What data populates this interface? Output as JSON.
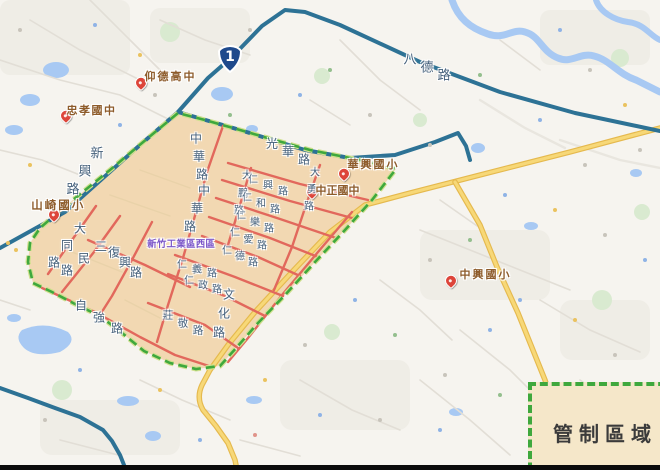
{
  "legend": {
    "label": "管制區域"
  },
  "shield": {
    "number": "1"
  },
  "colors": {
    "zone": "#f2d8b2",
    "border": "#3fa83d",
    "red": "#e2685c",
    "teal": "#2d7295",
    "yellow": "#f7d878",
    "water": "#a8c9f3",
    "label-road": "#46617c",
    "label-school": "#8d5b2a",
    "label-area": "#7a55c8",
    "marker": "#dd453a",
    "legend-bg": "#f5e7c9",
    "legend-text": "#3b3b3b"
  },
  "map": {
    "labels": [
      {
        "text": "八德路",
        "x": 410,
        "y": 58,
        "dx": 17,
        "dy": 8,
        "size": 13,
        "cls": "road"
      },
      {
        "text": "新興路",
        "x": 97,
        "y": 152,
        "dx": -12,
        "dy": 18,
        "size": 13,
        "cls": "road"
      },
      {
        "text": "光華路",
        "x": 272,
        "y": 143,
        "dx": 16,
        "dy": 8,
        "size": 12,
        "cls": "road"
      },
      {
        "text": "中華路",
        "x": 196,
        "y": 138,
        "dx": 3,
        "dy": 18,
        "size": 12,
        "cls": "road"
      },
      {
        "text": "中華路",
        "x": 204,
        "y": 190,
        "dx": -7,
        "dy": 18,
        "size": 12,
        "cls": "road"
      },
      {
        "text": "大勇路",
        "x": 315,
        "y": 171,
        "dx": -3,
        "dy": 17,
        "size": 10,
        "cls": "road"
      },
      {
        "text": "大鵬路",
        "x": 247,
        "y": 174,
        "dx": -4,
        "dy": 17.5,
        "size": 10,
        "cls": "road"
      },
      {
        "text": "文化路",
        "x": 229,
        "y": 294,
        "dx": -5,
        "dy": 19,
        "size": 12,
        "cls": "road"
      },
      {
        "text": "大同路",
        "x": 80,
        "y": 228,
        "dx": -13,
        "dy": 17,
        "size": 12,
        "cls": "road"
      },
      {
        "text": "三民路",
        "x": 101,
        "y": 246,
        "dx": -17,
        "dy": 12,
        "size": 12,
        "cls": "road"
      },
      {
        "text": "復興路",
        "x": 114,
        "y": 252,
        "dx": 11,
        "dy": 10,
        "size": 12,
        "cls": "road"
      },
      {
        "text": "自強路",
        "x": 81,
        "y": 305,
        "dx": 18,
        "dy": 11.5,
        "size": 12,
        "cls": "road"
      },
      {
        "text": "莊敬路",
        "x": 168,
        "y": 315,
        "dx": 15,
        "dy": 7.5,
        "size": 10.5,
        "cls": "road"
      },
      {
        "text": "仁興路",
        "x": 253,
        "y": 178,
        "dx": 15,
        "dy": 6,
        "size": 10,
        "cls": "road"
      },
      {
        "text": "仁和路",
        "x": 247,
        "y": 196,
        "dx": 14,
        "dy": 6,
        "size": 10,
        "cls": "road"
      },
      {
        "text": "仁樂路",
        "x": 241,
        "y": 214,
        "dx": 14,
        "dy": 6.5,
        "size": 10,
        "cls": "road"
      },
      {
        "text": "仁愛路",
        "x": 235,
        "y": 231,
        "dx": 13.5,
        "dy": 6.5,
        "size": 10,
        "cls": "road"
      },
      {
        "text": "仁德路",
        "x": 227,
        "y": 249,
        "dx": 13,
        "dy": 6,
        "size": 10,
        "cls": "road"
      },
      {
        "text": "仁義路",
        "x": 182,
        "y": 263,
        "dx": 15,
        "dy": 4.5,
        "size": 10,
        "cls": "road"
      },
      {
        "text": "仁政路",
        "x": 189,
        "y": 279,
        "dx": 14,
        "dy": 4.5,
        "size": 10,
        "cls": "road"
      },
      {
        "text": "仰德高中",
        "x": 150,
        "y": 76,
        "dx": 13,
        "dy": 0,
        "size": 11,
        "cls": "school"
      },
      {
        "text": "忠孝國中",
        "x": 72,
        "y": 110,
        "dx": 12.5,
        "dy": 0,
        "size": 11,
        "cls": "school"
      },
      {
        "text": "山崎國小",
        "x": 37,
        "y": 205,
        "dx": 13.5,
        "dy": 0,
        "size": 11.5,
        "cls": "school"
      },
      {
        "text": "華興國小",
        "x": 353,
        "y": 164,
        "dx": 13,
        "dy": 0,
        "size": 11,
        "cls": "school"
      },
      {
        "text": "中正國中",
        "x": 321,
        "y": 190,
        "dx": 11,
        "dy": 0,
        "size": 11,
        "cls": "school"
      },
      {
        "text": "中興國小",
        "x": 465,
        "y": 274,
        "dx": 13,
        "dy": 0,
        "size": 11,
        "cls": "school"
      },
      {
        "text": "新竹工業區西區",
        "x": 152,
        "y": 243,
        "dx": 9.7,
        "dy": 0,
        "size": 9.5,
        "cls": "area"
      }
    ],
    "markers": [
      {
        "name": "marker-yangde-high-school",
        "x": 141,
        "y": 84
      },
      {
        "name": "marker-zhongxiao-junior-high",
        "x": 66,
        "y": 117
      },
      {
        "name": "marker-shanqi-elementary",
        "x": 54,
        "y": 216
      },
      {
        "name": "marker-huaxing-elementary",
        "x": 344,
        "y": 175
      },
      {
        "name": "marker-zhongzheng-junior-high",
        "x": 312,
        "y": 193
      },
      {
        "name": "marker-zhongxing-elementary",
        "x": 451,
        "y": 282
      }
    ]
  }
}
